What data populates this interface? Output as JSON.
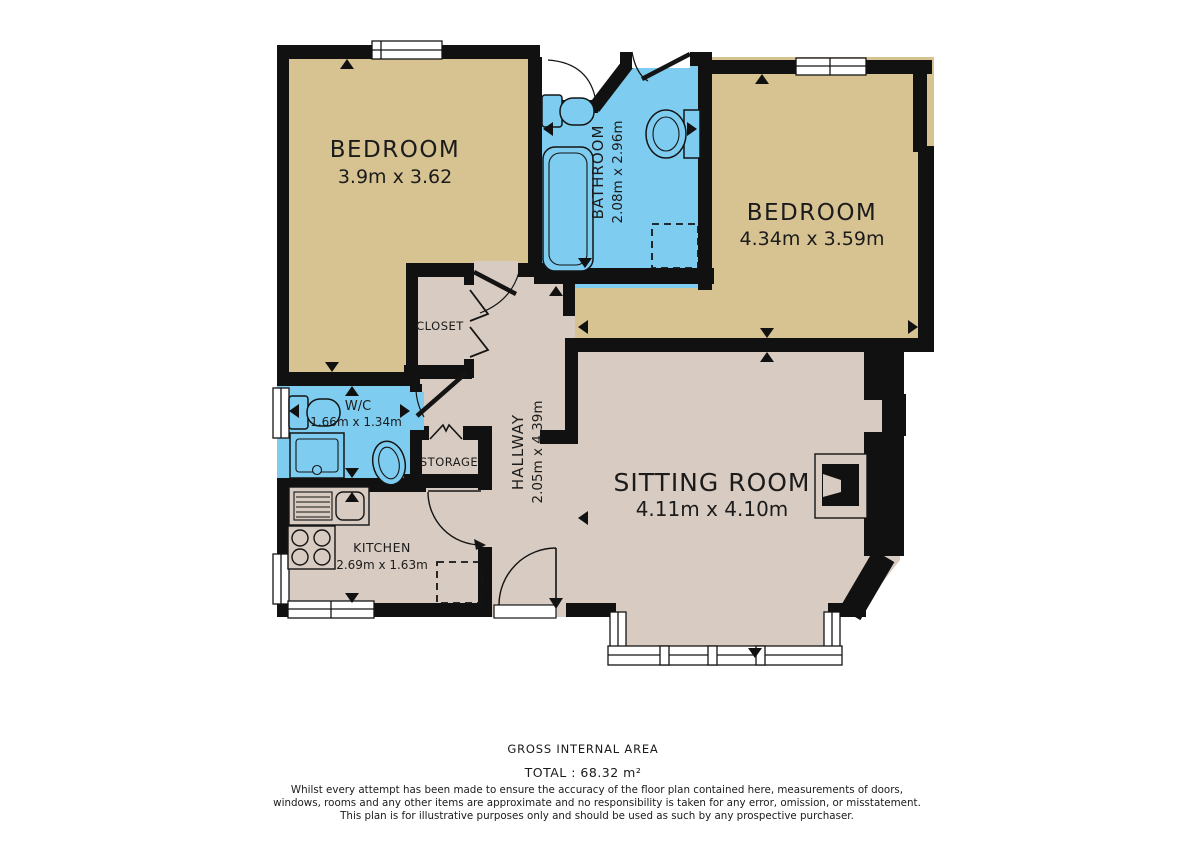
{
  "floorplan": {
    "rooms": [
      {
        "name": "BEDROOM",
        "dims": "3.9m x 3.62"
      },
      {
        "name": "BATHROOM",
        "dims": "2.08m x 2.96m"
      },
      {
        "name": "BEDROOM",
        "dims": "4.34m x 3.59m"
      },
      {
        "name": "CLOSET",
        "dims": ""
      },
      {
        "name": "W/C",
        "dims": "1.66m x 1.34m"
      },
      {
        "name": "STORAGE",
        "dims": ""
      },
      {
        "name": "HALLWAY",
        "dims": "2.05m x 4.39m"
      },
      {
        "name": "KITCHEN",
        "dims": "2.69m x 1.63m"
      },
      {
        "name": "SITTING ROOM",
        "dims": "4.11m x 4.10m"
      }
    ],
    "colors": {
      "bedroom_floor": "#d6c391",
      "wet_room_floor": "#7ecdf0",
      "living_floor": "#d8cbc1",
      "wall": "#111111",
      "background": "#ffffff"
    },
    "footer": {
      "area_label": "GROSS INTERNAL AREA",
      "total": "TOTAL : 68.32 m²",
      "disclaimer": [
        "Whilst every attempt has been made to ensure the accuracy of the floor plan contained here, measurements of doors,",
        "windows, rooms and any other items are approximate and no responsibility is taken for any error, omission, or misstatement.",
        "This plan is for illustrative purposes only and should be used as such by any prospective purchaser."
      ]
    }
  }
}
